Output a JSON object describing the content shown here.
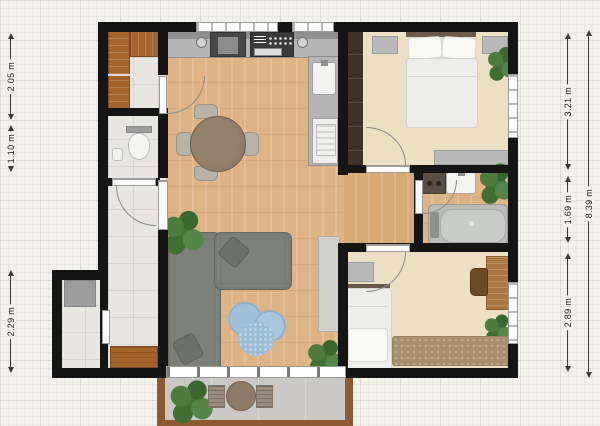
{
  "title": "Apartment floor plan",
  "measurements": {
    "left": [
      {
        "label": "2.05 m"
      },
      {
        "label": "1.10 m"
      },
      {
        "label": "2.29 m"
      }
    ],
    "right": [
      {
        "label": "3.21 m"
      },
      {
        "label": "1.69 m"
      },
      {
        "label": "2.89 m"
      },
      {
        "label": "8.39 m"
      }
    ]
  },
  "palette": {
    "bg": "#f2f1ec",
    "wall": "#151515",
    "wood": "#deb386",
    "wood2": "#d9ab74",
    "beige": "#ecdfc4",
    "tile": "#e7e6e2",
    "balcony": "#c9c8c4",
    "accentwood": "#a5642a",
    "sofa": "#7e807b",
    "counter": "#b5b5b5",
    "rug_blue": "#9fc0d8",
    "rug_brown": "#a78f6b"
  }
}
